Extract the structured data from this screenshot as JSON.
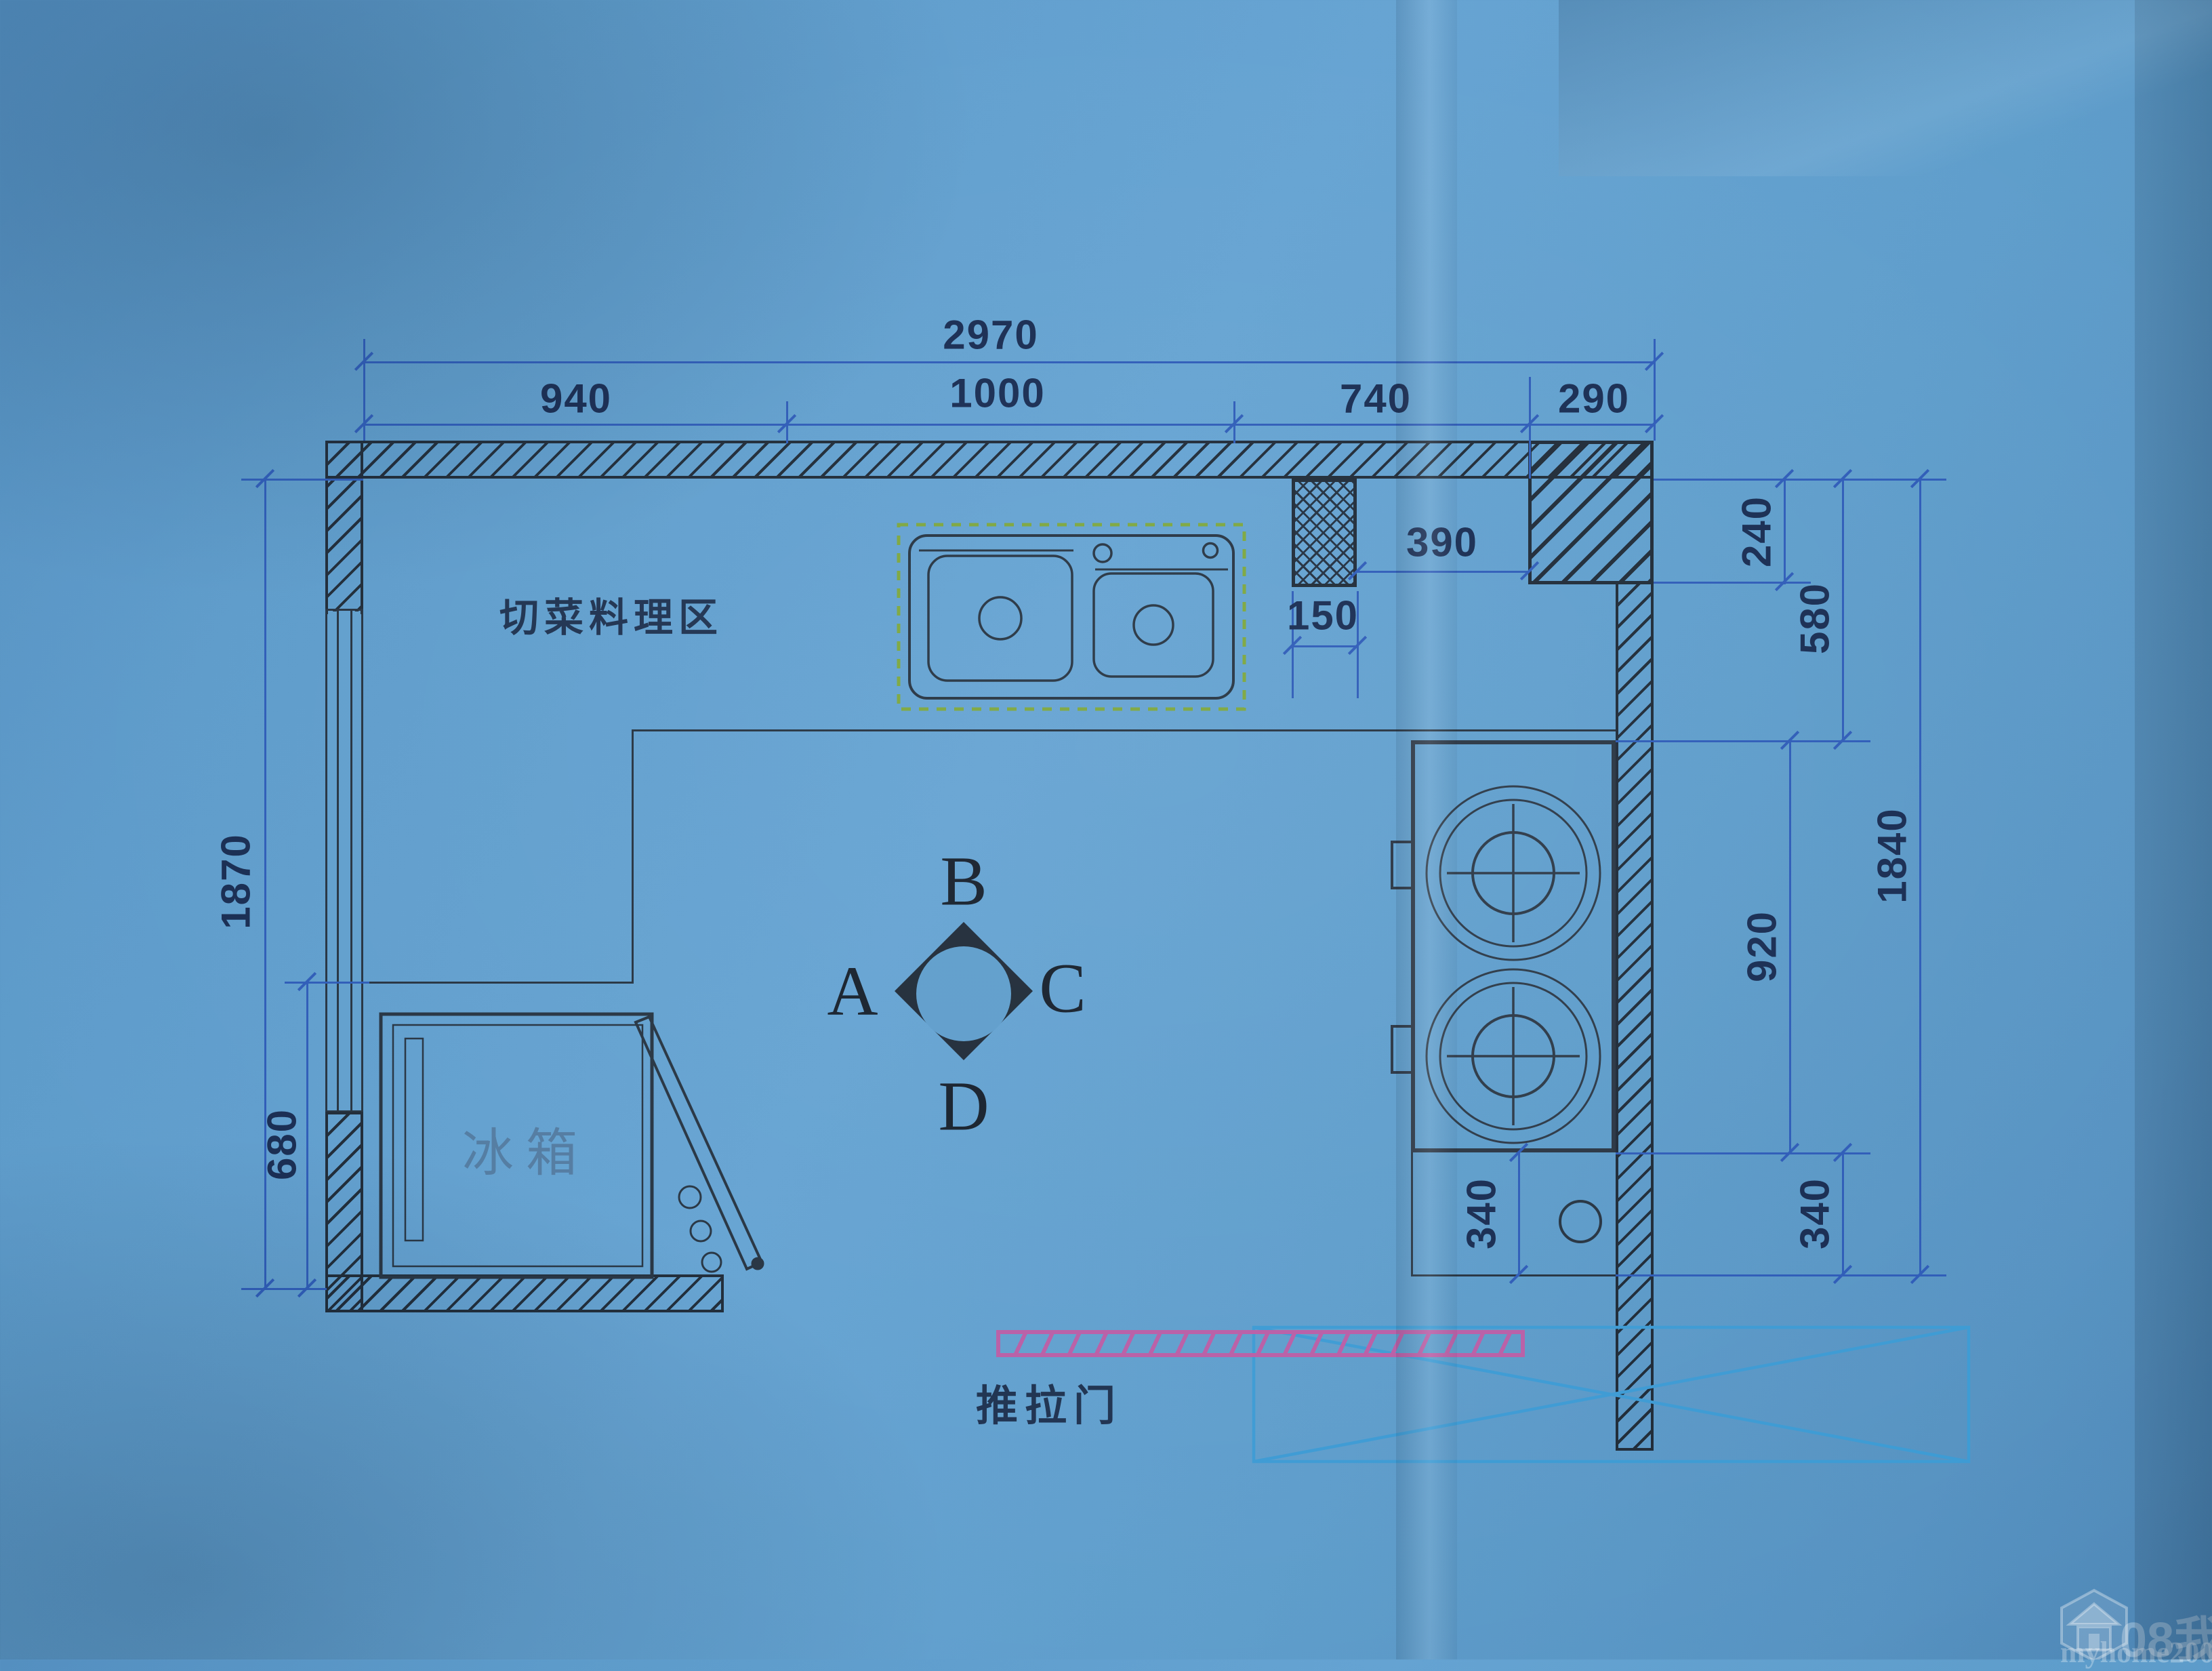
{
  "dims": {
    "top_total": "2970",
    "top_segments": [
      "940",
      "1000",
      "740",
      "290"
    ],
    "col_offset": "390",
    "col_width": "150",
    "right_240": "240",
    "right_580": "580",
    "right_920": "920",
    "right_1840": "1840",
    "right_340_outer": "340",
    "inner_340": "340",
    "left_1870": "1870",
    "left_680": "680"
  },
  "labels": {
    "prep_area": "切菜料理区",
    "fridge": "冰箱",
    "sliding_door": "推拉门"
  },
  "compass": {
    "top": "B",
    "left": "A",
    "right": "C",
    "bottom": "D"
  },
  "watermark": {
    "site": "08我家",
    "url": "myhome2008.com"
  },
  "colors": {
    "paper_blue": "#5e9dcb",
    "ink_dark": "#1f2b38",
    "dimension_blue": "#2e5cb8",
    "sink_dashed_green": "#7ca63e",
    "sliding_door_pink": "#b95fa6",
    "annotation_box_blue": "#3d9bd4",
    "fridge_text_blue": "#527ba1"
  }
}
